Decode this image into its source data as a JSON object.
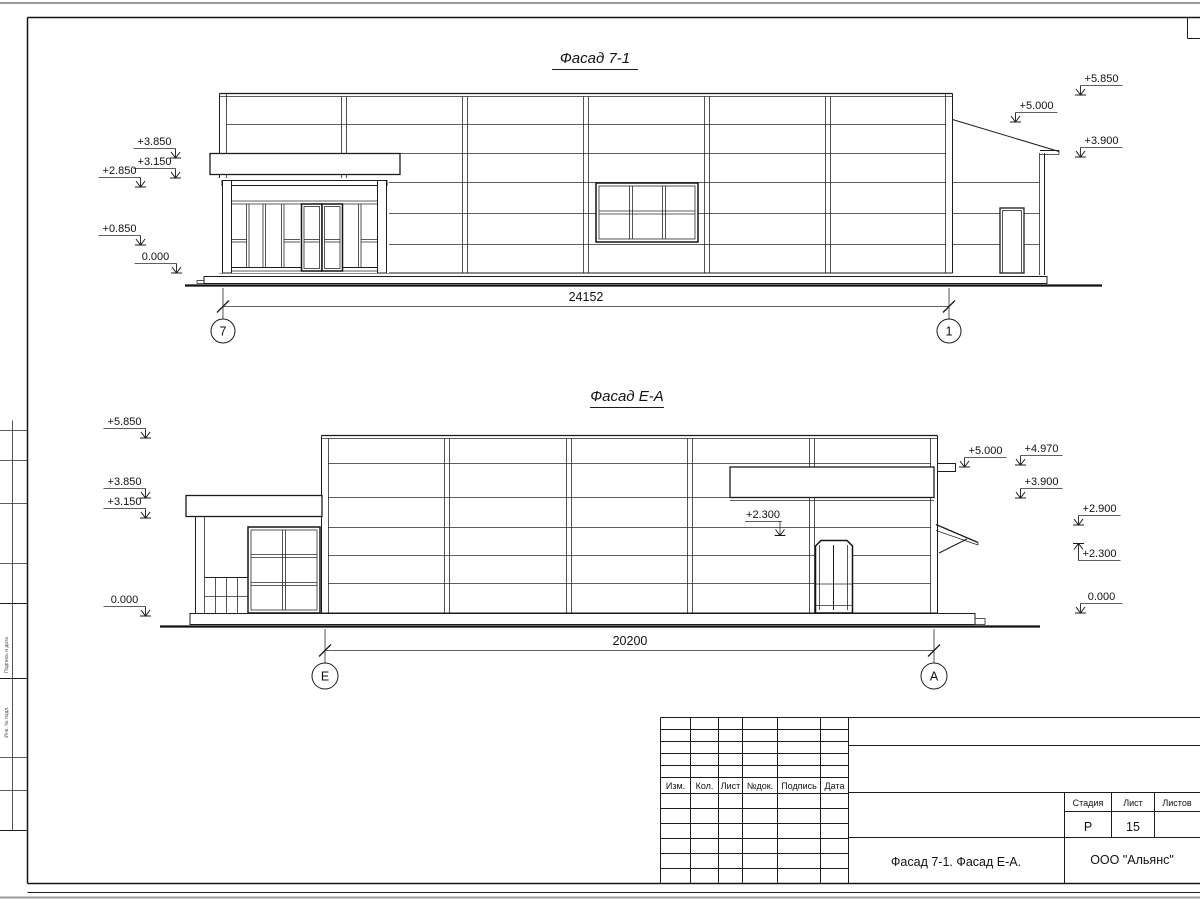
{
  "facade_top": {
    "title": "Фасад 7-1",
    "dimension": "24152",
    "grid_left": "7",
    "grid_right": "1",
    "levels_left": [
      "+3.850",
      "+3.150",
      "+2.850",
      "+0.850",
      "0.000"
    ],
    "levels_right": [
      "+5.850",
      "+5.000",
      "+3.900"
    ]
  },
  "facade_bottom": {
    "title": "Фасад Е-А",
    "dimension": "20200",
    "grid_left": "Е",
    "grid_right": "А",
    "levels_left": [
      "+5.850",
      "+3.850",
      "+3.150",
      "0.000"
    ],
    "levels_right": [
      "+5.000",
      "+4.970",
      "+3.900",
      "+2.900",
      "+2.300",
      "0.000"
    ],
    "annotation": "+2.300"
  },
  "title_block": {
    "columns": [
      "Изм.",
      "Кол.",
      "Лист",
      "№док.",
      "Подпись",
      "Дата"
    ],
    "stage_label": "Стадия",
    "sheet_label": "Лист",
    "sheets_label": "Листов",
    "stage_value": "Р",
    "sheet_value": "15",
    "sheets_value": "",
    "drawing_title": "Фасад 7-1. Фасад Е-А.",
    "company": "ООО \"Альянс\""
  },
  "side_stamp": {
    "labels": [
      "Подпись и дата",
      "Инв. № подл."
    ]
  },
  "colors": {
    "line": "#1c1c1c",
    "paper": "#ffffff"
  }
}
